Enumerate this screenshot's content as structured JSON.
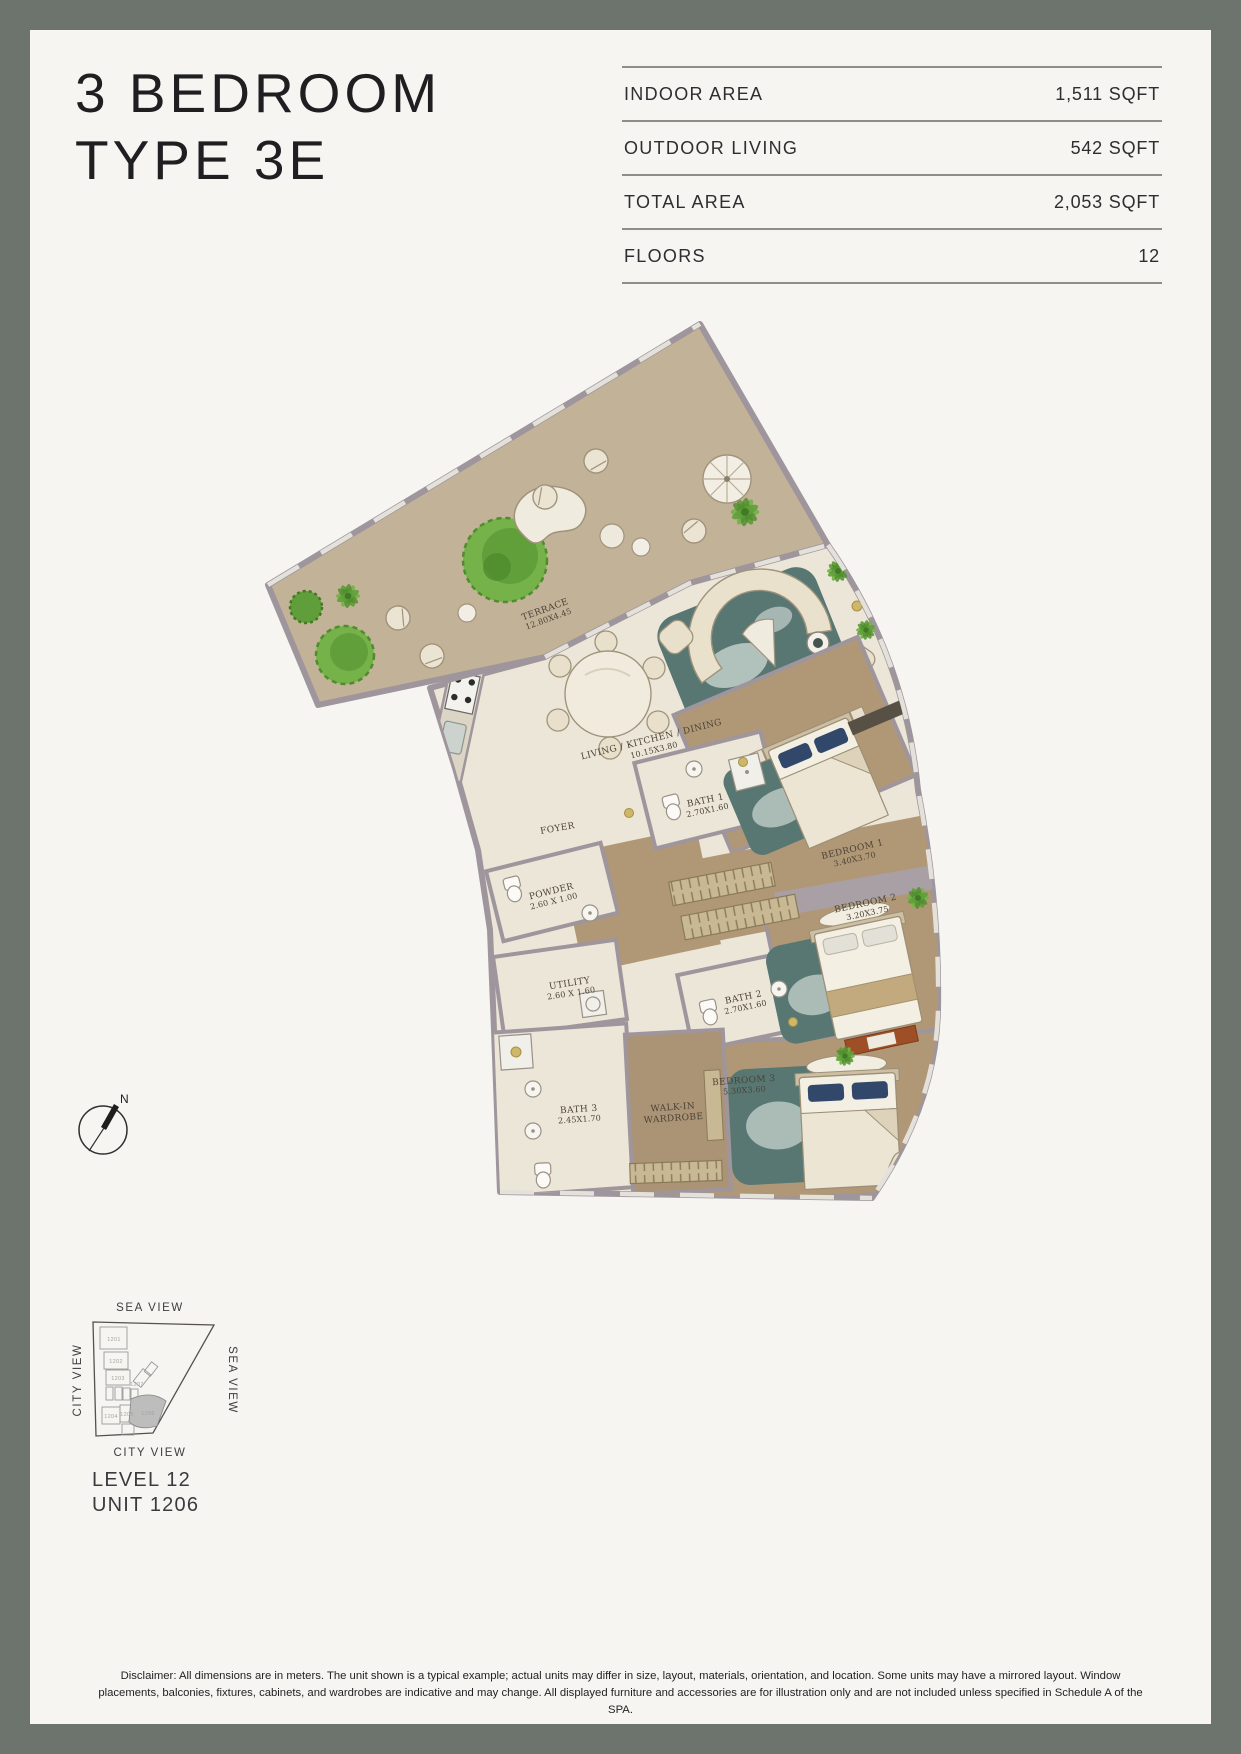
{
  "header": {
    "title_line1": "3 BEDROOM",
    "title_line2": "TYPE 3E"
  },
  "stats": {
    "rows": [
      {
        "label": "INDOOR AREA",
        "value": "1,511 SQFT"
      },
      {
        "label": "OUTDOOR LIVING",
        "value": "542 SQFT"
      },
      {
        "label": "TOTAL AREA",
        "value": "2,053 SQFT"
      },
      {
        "label": "FLOORS",
        "value": "12"
      }
    ]
  },
  "plan": {
    "rooms": [
      {
        "line1": "TERRACE",
        "line2": "12.80X4.45"
      },
      {
        "line1": "LIVING / KITCHEN / DINING",
        "line2": "10.15X3.80"
      },
      {
        "line1": "FOYER",
        "line2": ""
      },
      {
        "line1": "BATH 1",
        "line2": "2.70X1.60"
      },
      {
        "line1": "POWDER",
        "line2": "2.60 X 1.00"
      },
      {
        "line1": "UTILITY",
        "line2": "2.60 X 1.60"
      },
      {
        "line1": "BATH 2",
        "line2": "2.70X1.60"
      },
      {
        "line1": "BATH 3",
        "line2": "2.45X1.70"
      },
      {
        "line1": "WALK-IN",
        "line2": "WARDROBE"
      },
      {
        "line1": "BEDROOM 1",
        "line2": "3.40X3.70"
      },
      {
        "line1": "BEDROOM 2",
        "line2": "3.20X3.75"
      },
      {
        "line1": "BEDROOM 3",
        "line2": "5.30X3.60"
      }
    ]
  },
  "compass": {
    "label": "N"
  },
  "keyplan": {
    "view_top": "SEA VIEW",
    "view_left": "CITY VIEW",
    "view_right": "SEA VIEW",
    "view_bottom": "CITY VIEW",
    "units": [
      "1201",
      "1202",
      "1203",
      "1207",
      "1204",
      "1205",
      "1206"
    ],
    "highlighted_unit": "1206",
    "level_label": "LEVEL 12",
    "unit_label": "UNIT 1206"
  },
  "disclaimer": "Disclaimer: All dimensions are in meters. The unit shown is a typical example; actual units may differ in size, layout, materials, orientation, and location. Some units may have a mirrored layout. Window placements, balconies, fixtures, cabinets, and wardrobes are indicative and may change. All displayed furniture and accessories are for illustration only and are not included unless specified in Schedule A of the SPA.",
  "colors": {
    "frame": "#6d736d",
    "paper": "#f6f5f2",
    "terrace_floor": "#c2b298",
    "indoor_floor": "#ece6d8",
    "bedroom_floor": "#b09877",
    "wall": "#9e969c",
    "rug_teal": "#587773",
    "pillow_navy": "#31486a",
    "accent_gold": "#cdb76a",
    "plant_green": "#76b24a",
    "keyplan_highlight": "#bdbdbd"
  }
}
